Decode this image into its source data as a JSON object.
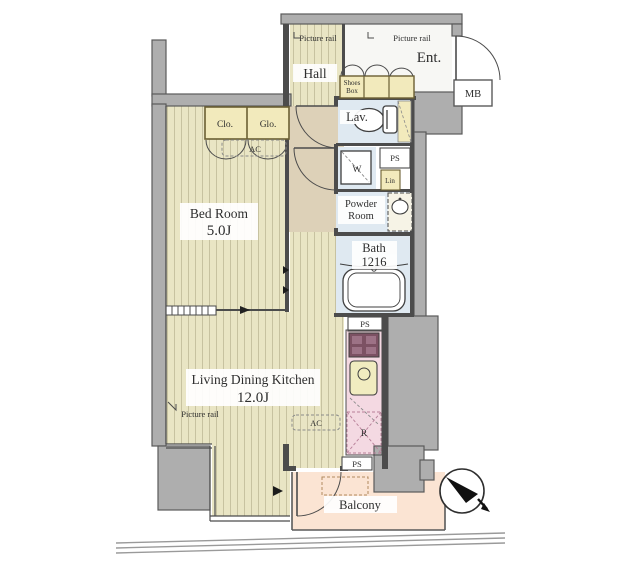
{
  "plan": {
    "type": "apartment-floor-plan",
    "rooms": {
      "hall": "Hall",
      "entrance": "Ent.",
      "bedroom_name": "Bed Room",
      "bedroom_size": "5.0J",
      "ldk_name": "Living Dining Kitchen",
      "ldk_size": "12.0J",
      "lavatory": "Lav.",
      "powder_line1": "Powder",
      "powder_line2": "Room",
      "bath_name": "Bath",
      "bath_size": "1216",
      "balcony": "Balcony"
    },
    "labels": {
      "picture_rail_hall": "Picture rail",
      "picture_rail_ent": "Picture rail",
      "picture_rail_ldk": "Picture rail",
      "shoes_box_line1": "Shoes",
      "shoes_box_line2": "Box",
      "meter_box": "MB",
      "closet_left": "Clo.",
      "closet_right": "Glo.",
      "ac_bedroom": "AC",
      "ac_ldk": "AC",
      "washer": "W",
      "linen": "Lin",
      "ps_top": "PS",
      "ps_mid": "PS",
      "ps_bottom": "PS",
      "refrigerator": "R"
    },
    "icons": {
      "compass": "compass-north-icon",
      "balcony_marker": "right-triangle-marker"
    },
    "colors": {
      "wall_fill": "#aeaeae",
      "wall_stroke": "#5a5a5a",
      "flooring": "#e9e5c4",
      "flooring_stripe": "#c7c2a0",
      "corridor": "#ddd1b8",
      "closet": "#f2eabc",
      "wet_room": "#dfe9f1",
      "kitchen": "#f4d9e2",
      "sink": "#f1ecc0",
      "balcony": "#fbe4d3",
      "stove": "#7c5163",
      "entrance_floor": "#f7f7f4",
      "label_plate": "#ffffff",
      "text": "#2e2e2e"
    }
  }
}
